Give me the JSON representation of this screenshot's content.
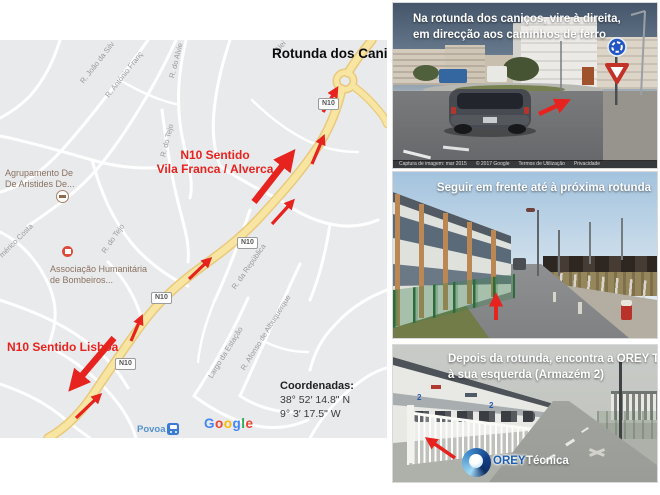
{
  "map": {
    "title": "Rotunda dos Caniços",
    "direction_north_line1": "N10 Sentido",
    "direction_north_line2": "Vila Franca / Alverca",
    "direction_south": "N10 Sentido Lisboa",
    "coordinates": {
      "heading": "Coordenadas:",
      "latitude": "38° 52′ 14.8\" N",
      "longitude": "9° 3′ 17.5\" W"
    },
    "shield_label": "N10",
    "street_labels": {
      "joao": "R. João da Silv",
      "antonio": "R. António Franç",
      "alvie": "R. do Alvie",
      "tejo_upper": "R. do Tejo",
      "americo": "mérico Costa",
      "tejo_lower": "R. do Tejo",
      "republica": "R. da República",
      "largo": "Largo da Estação",
      "afonso": "R. Afonso de Albuquerque",
      "aleia": "Alei"
    },
    "pois": {
      "school_line1": "Agrupamento De",
      "school_line2": "De Aristides De...",
      "fire_line1": "Associação Humanitária",
      "fire_line2": "de Bombeiros..."
    },
    "station": "Povoa",
    "google": [
      "G",
      "o",
      "o",
      "g",
      "l",
      "e"
    ]
  },
  "streetviews": [
    {
      "caption_line1": "Na rotunda dos caniços, vire à direita,",
      "caption_line2": "em direcção aos caminhos de ferro",
      "attribution": [
        "Captura de imagem: mar 2015",
        "© 2017 Google",
        "Termos de Utilização",
        "Privacidade"
      ]
    },
    {
      "caption": "Seguir em frente até à próxima rotunda"
    },
    {
      "caption_line1": "Depois da rotunda, encontra a OREY Técnica",
      "caption_line2": "à sua esquerda (Armazém 2)",
      "warehouse_number": "2",
      "logo_name": "OREY",
      "logo_suffix": "Técnica"
    }
  ]
}
